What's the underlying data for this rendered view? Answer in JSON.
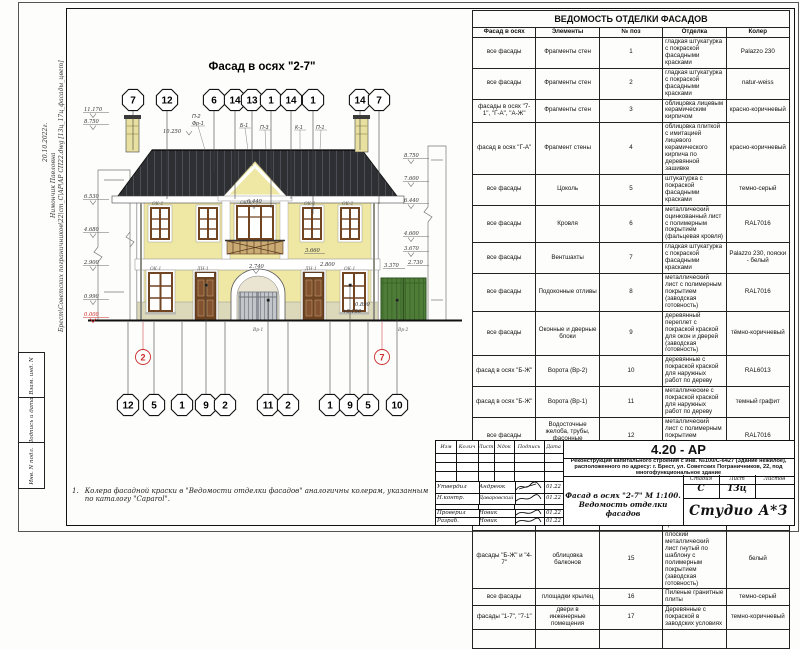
{
  "sheet": {
    "meta_vertical": {
      "date": "20.10.2022г.",
      "name": "Нимончик Павловна",
      "path": "Брест\\Советских пограничников\\22\\cm_C\\АР\\АР СП22.dwg [13ц_17ц_фасады_цвет]"
    },
    "stamp_boxes": [
      "Взам. инд. N",
      "Подпись и дата",
      "Инв. N подл."
    ],
    "note_number": "1.",
    "note_line1": "Колера фасадной краски в \"Ведомости отделки фасадов\" аналогичны колерам, указанным",
    "note_line2": "по каталогу \"Caparol\"."
  },
  "drawing": {
    "title": "Фасад в осях \"2-7\"",
    "bubbles_top": [
      "7",
      "12",
      "6",
      "14",
      "13",
      "1",
      "14",
      "1",
      "14",
      "7"
    ],
    "bubbles_bottom": [
      "12",
      "5",
      "1",
      "9",
      "2",
      "11",
      "2",
      "1",
      "9",
      "5",
      "10"
    ],
    "red_circles": [
      "2",
      "7"
    ],
    "part_labels": [
      "П-2",
      "Фр-1",
      "Б-1",
      "П-3",
      "К-1",
      "П-1"
    ],
    "levels_left": [
      "11.170",
      "8.750",
      "6.530",
      "4.680",
      "2.900",
      "0.990",
      "0.000"
    ],
    "levels_right": [
      "8.750",
      "7.600",
      "6.440",
      "4.600",
      "3.670",
      "3.370",
      "2.730"
    ],
    "dims": {
      "overall": "10.250",
      "center": "6.440",
      "arch": "2.740",
      "balcony": "3.660",
      "right_low": "2.800",
      "entry": "+0.150",
      "sill": "0.890"
    },
    "tags": {
      "ok2_a": "ОК-2",
      "ok3": "ОК-3",
      "ok2_b": "ОК-2",
      "ok2_c": "ОК-2",
      "ok1_a": "ОК-1",
      "dn1_a": "ДН-1",
      "dn1_b": "ДН-1",
      "ok1_b": "ОК-1",
      "vr1": "Вр-1",
      "vr2": "Вр-2"
    },
    "colors": {
      "wall": "#efe8a5",
      "roof": "#2d2f33",
      "trim": "#ffffff",
      "wood": "#714422",
      "gate_green": "#4e7d37",
      "metal": "#c2c6cb",
      "level_red": "#cc2a2a"
    }
  },
  "finish_table": {
    "title": "ВЕДОМОСТЬ ОТДЕЛКИ ФАСАДОВ",
    "headers": [
      "Фасад в осях",
      "Элементы",
      "№ поз",
      "Отделка",
      "Колер"
    ],
    "rows": [
      [
        "все фасады",
        "Фрагменты стен",
        "1",
        "гладкая штукатурка с покраской фасадными красками",
        "Palazzo 230"
      ],
      [
        "все фасады",
        "Фрагменты стен",
        "2",
        "гладкая штукатурка с покраской фасадными красками",
        "natur-weiss"
      ],
      [
        "фасады в осях \"7-1\", \"Г-А\", \"А-Ж\"",
        "Фрагменты стен",
        "3",
        "облицовка лицевым керамическим кирпичом",
        "красно-коричневый"
      ],
      [
        "фасад в осях \"Г-А\"",
        "Фрагмент стены",
        "4",
        "облицовка плиткой с имитацией лицевого керамического кирпича по деревянной зашивке",
        "красно-коричневый"
      ],
      [
        "все фасады",
        "Цоколь",
        "5",
        "штукатурка с покраской фасадными красками",
        "темно-серый"
      ],
      [
        "все фасады",
        "Кровля",
        "6",
        "металлический оцинкованный лист с полимерным покрытием (фальцевая кровля)",
        "RAL7016"
      ],
      [
        "все фасады",
        "Вентшахты",
        "7",
        "гладкая штукатурка с покраской фасадными красками",
        "Palazzo 230, пояски - белый"
      ],
      [
        "все фасады",
        "Подоконные отливы",
        "8",
        "металлический лист с полимерным покрытием (заводская готовность)",
        "RAL7016"
      ],
      [
        "все фасады",
        "Оконные и дверные блоки",
        "9",
        "деревянный переплет с покраской краской для окон и дверей (заводская готовность)",
        "тёмно-коричневый"
      ],
      [
        "фасад в осях \"Б-Ж\"",
        "Ворота (Вр-2)",
        "10",
        "деревянные с покраской краской для наружных работ  по дереву",
        "RAL6013"
      ],
      [
        "фасад в осях \"Б-Ж\"",
        "Ворота (Вр-1)",
        "11",
        "металлические с покраской краской для наружных работ  по дереву",
        "темный графит"
      ],
      [
        "все фасады",
        "Водосточные желоба, трубы, фасонные элементы кровли",
        "12",
        "металлический лист с полимерным покрытием (заводская готовность)",
        "RAL7016"
      ],
      [
        "фасады \"Б-Ж\", \"Ж-Б\", \"7-1\"",
        "Ограждение балконов, металлические элементы козырьков",
        "13",
        "Металлическое с покраской фасадными красками по металлу",
        "темный грфит"
      ],
      [
        "все фасады",
        "фасадные декоративные пояса, карнизы",
        "14",
        "Армированный пенополистирол с покраской фасадными красками",
        "белый"
      ],
      [
        "фасады \"Б-Ж\" и \"4-7\"",
        "облицовка балконов",
        "15",
        "плоский металлический лист гнутый по шаблону с полимерным покрытием (заводская готовность)",
        "белый"
      ],
      [
        "все фасады",
        "площадки крылец",
        "16",
        "Пиленые гранитные плиты",
        "темно-серый"
      ],
      [
        "фасады \"1-7\", \"7-1\"",
        "двери в инженерные помещения",
        "17",
        "Деревянные с покраской в заводских условиях",
        "темно-коричневый"
      ],
      [
        "",
        "",
        "",
        "",
        ""
      ]
    ]
  },
  "title_block": {
    "code": "4.20 - АР",
    "rev_headers": [
      "Изм",
      "Колич",
      "Лист",
      "Nдок",
      "Подпись",
      "Дата"
    ],
    "description": "Реконструкция капитального строения с инв. №100/С-6427 (Здание нежилое), расположенного по адресу: г. Брест, ул. Советских Пограничников, 22, под многофункциональное здание",
    "signatures": [
      {
        "role": "Утвердил",
        "name": "Андреюк",
        "date": "01.22"
      },
      {
        "role": "Н.контр.",
        "name": "Даваровский",
        "date": "01.22"
      },
      {
        "role": "Проверил",
        "name": "Новик",
        "date": "01.22"
      },
      {
        "role": "Разраб.",
        "name": "Новик",
        "date": "01.22"
      }
    ],
    "stage_headers": [
      "Стадия",
      "Лист",
      "Листов"
    ],
    "stage": "С",
    "sheet_num": "13ц",
    "sheets_total": "",
    "doc_title_line1": "Фасад в осях \"2-7\" М 1:100.",
    "doc_title_line2": "Ведомость отделки фасадов",
    "logo": "Студио А*З"
  }
}
